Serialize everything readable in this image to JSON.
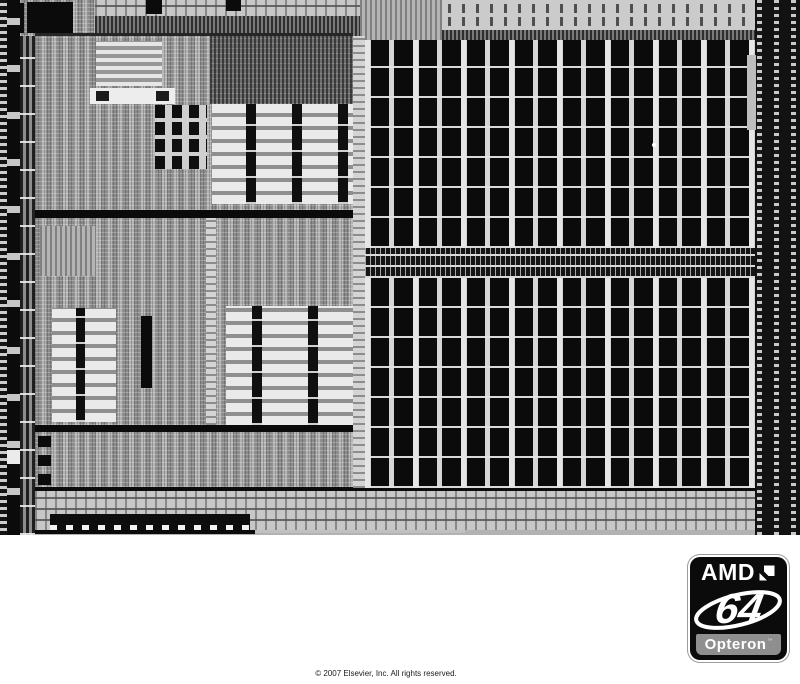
{
  "figure": {
    "copyright": "© 2007 Elsevier, Inc. All rights reserved."
  },
  "logo": {
    "brand": "AMD",
    "number": "64",
    "product": "Opteron",
    "trademark": "™"
  },
  "colors": {
    "page-bg": "#ffffff",
    "caption-text": "#1a1a1a",
    "die-base": "#b2b2b2",
    "die-black": "#0b0b0b",
    "die-light": "#d6d6d6",
    "badge-bg": "#0b0b0b",
    "badge-border": "#ffffff",
    "badge-outline": "#9c9c9c",
    "badge-bar": "#8f8f8f",
    "badge-text": "#ffffff"
  }
}
